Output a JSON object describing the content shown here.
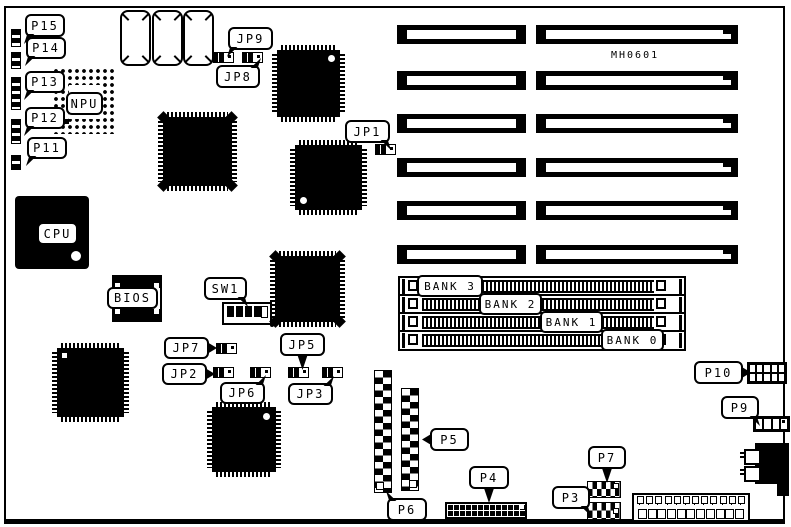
{
  "doc": {
    "part_number": "MH0601"
  },
  "colors": {
    "ink": "#000000",
    "paper": "#ffffff"
  },
  "callouts": {
    "p15": "P15",
    "p14": "P14",
    "p13": "P13",
    "p12": "P12",
    "p11": "P11",
    "jp9": "JP9",
    "jp8": "JP8",
    "jp1": "JP1",
    "npu": "NPU",
    "cpu": "CPU",
    "bios": "BIOS",
    "sw1": "SW1",
    "jp7": "JP7",
    "jp2": "JP2",
    "jp6": "JP6",
    "jp5": "JP5",
    "jp3": "JP3",
    "p5": "P5",
    "p6": "P6",
    "p4": "P4",
    "p3": "P3",
    "p7": "P7",
    "p9": "P9",
    "p10": "P10"
  },
  "memory_banks": [
    {
      "label": "BANK 3"
    },
    {
      "label": "BANK 2"
    },
    {
      "label": "BANK 1"
    },
    {
      "label": "BANK 0"
    }
  ],
  "counts": {
    "expansion_slots": 12,
    "simm_sockets": 4
  }
}
